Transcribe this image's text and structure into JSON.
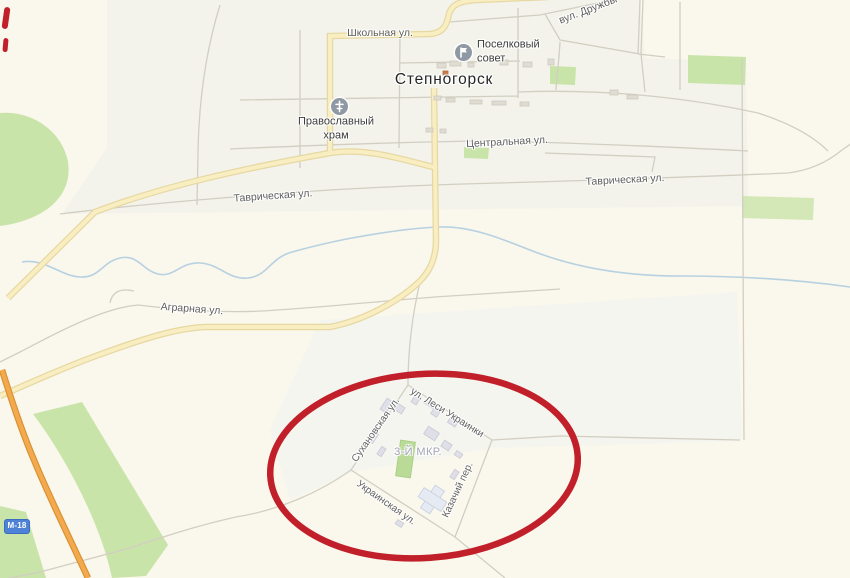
{
  "map": {
    "town": {
      "label": "Степногорск"
    },
    "district": {
      "label": "3-Й МКР."
    },
    "route_badge": {
      "label": "М-18",
      "color": "#4d82d6"
    },
    "pois": [
      {
        "id": "poselkovy-sovet",
        "line1": "Поселковый",
        "line2": "совет",
        "icon": "flag-icon"
      },
      {
        "id": "pravoslavny-khram",
        "line1": "Православный",
        "line2": "храм",
        "icon": "orthodox-cross-icon"
      }
    ],
    "streets": {
      "shkolnaya": "Школьная ул.",
      "tsentralnaya": "Центральная ул.",
      "tavricheskaya_west": "Таврическая ул.",
      "tavricheskaya_east": "Таврическая ул.",
      "agrarnaya": "Аграрная ул.",
      "druzhby": "вул. Дружбы",
      "sukhanovskaya": "Сухановская ул.",
      "lesi_ukrainki": "ул. Леси Украинки",
      "ukrainskaya": "Украинская ул.",
      "kazachiy": "Казачий пер."
    },
    "annotation": {
      "type": "ellipse",
      "color": "#c1202a"
    },
    "colors": {
      "background": "#faf7ec",
      "urban": "#f3f3ec",
      "green": "#c9e4a9",
      "water": "#b7d1e1",
      "road_yellow": "#f8eec2",
      "road_orange": "#f3aa4e",
      "annotation_red": "#c1202a"
    }
  }
}
